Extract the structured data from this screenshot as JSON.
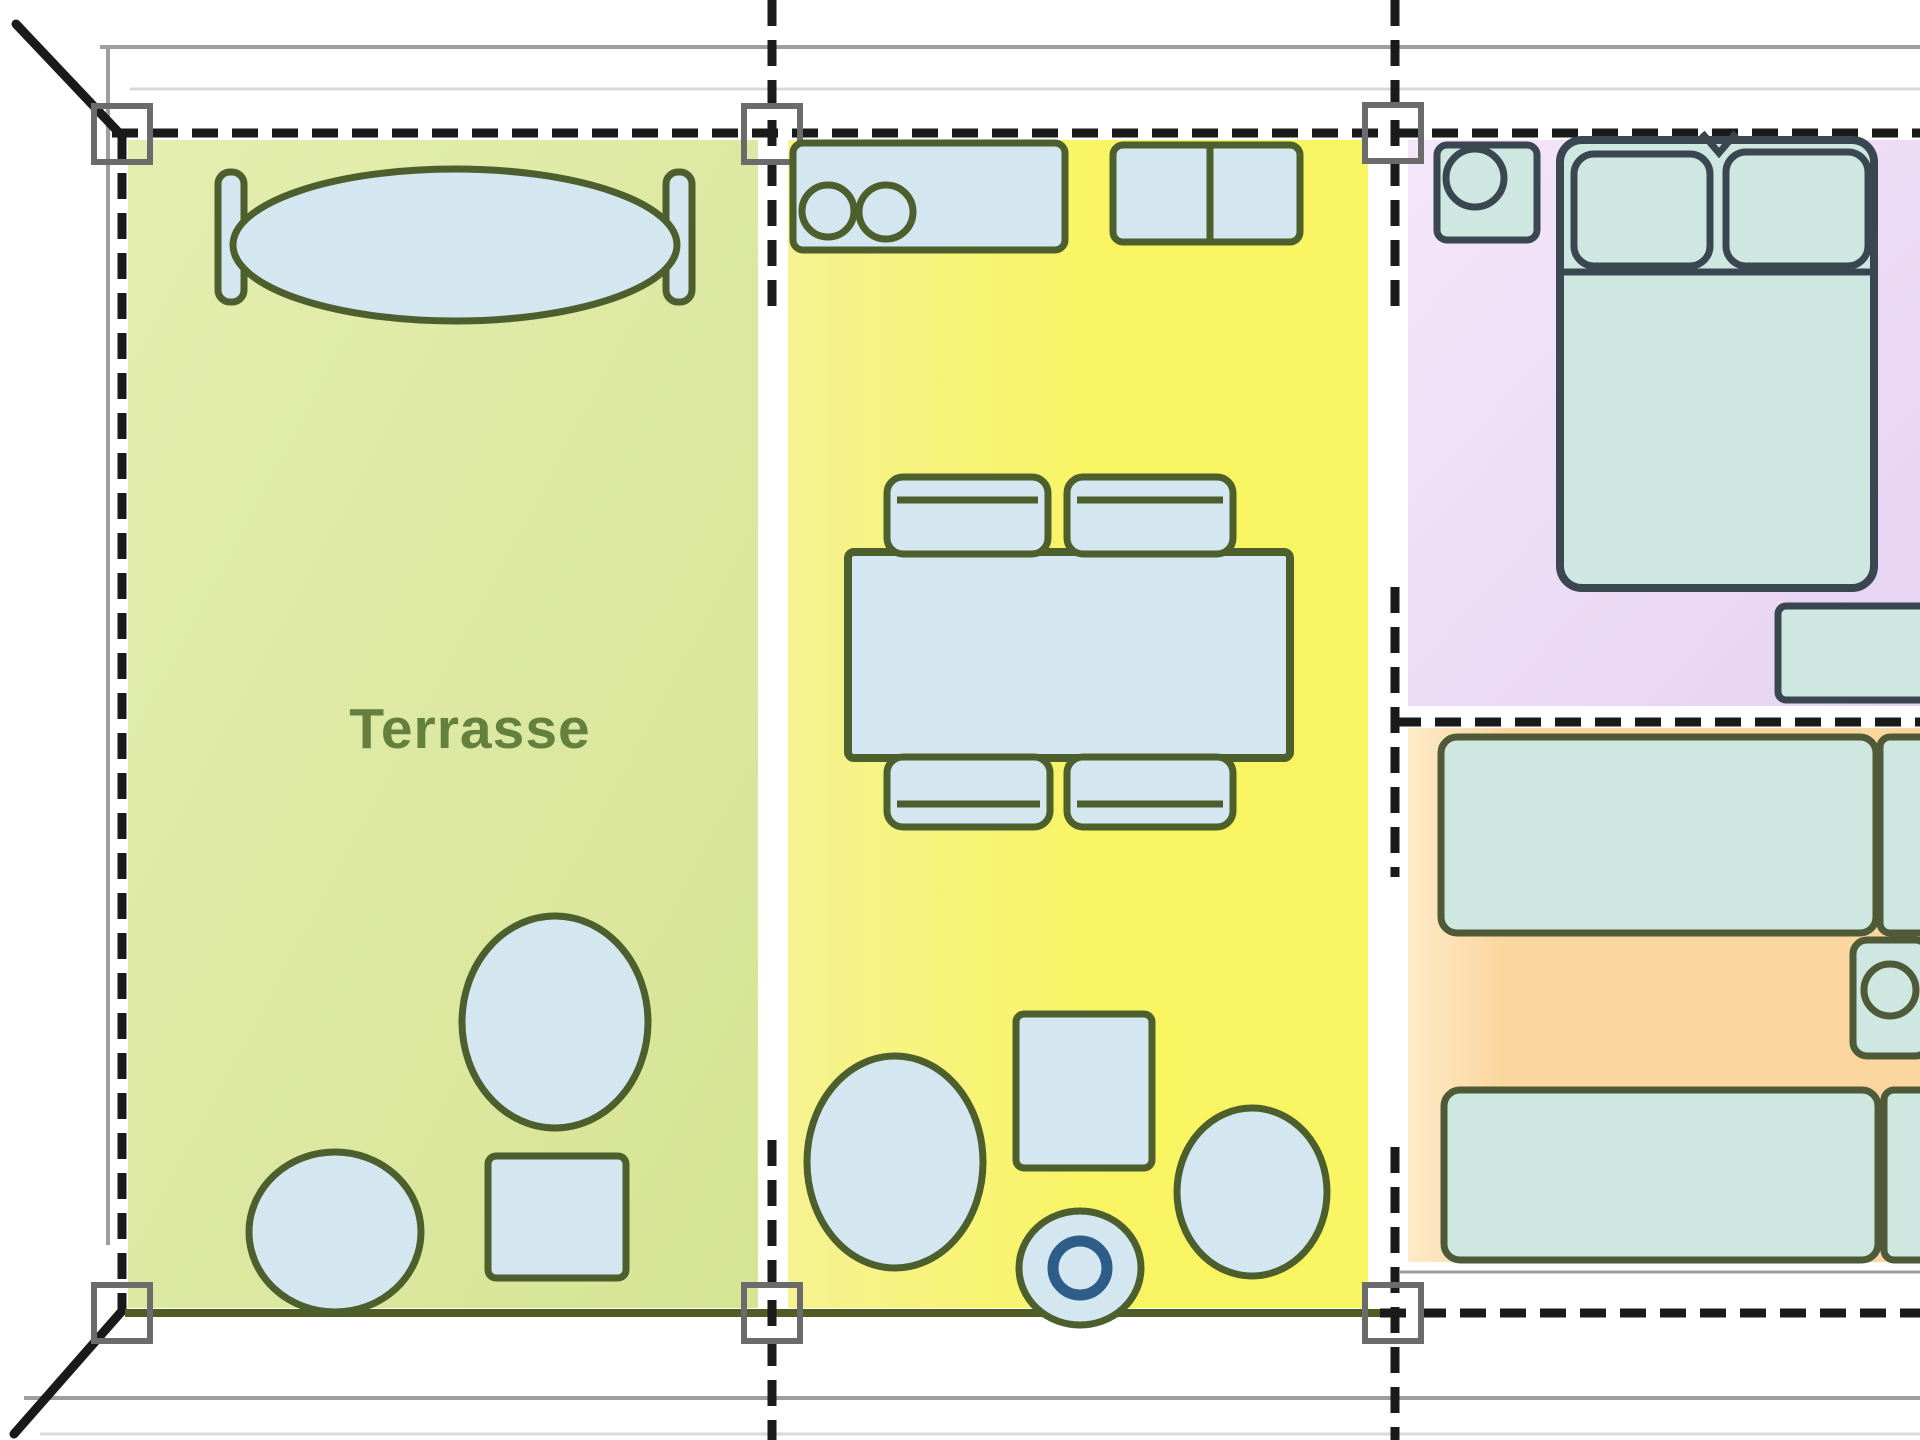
{
  "figure": {
    "type": "floor-plan",
    "terrace_label": "Terrasse"
  },
  "palette": {
    "guide_gray": "#9e9e9e",
    "guide_faint": "#d9d9d9",
    "wall_black": "#1a1a1a",
    "post_gray": "#6b6b6b",
    "olive_edge": "#4f5c23",
    "olive_stroke": "#4c5f2c",
    "olive2_stroke": "#4e5a38",
    "slate_stroke": "#3a4751",
    "blue_fill": "#d4e6f0",
    "teal_fill": "#cfe7e1",
    "ring_blue": "#2e5d8a",
    "label_green": "#64803f",
    "terrace_fill_a": "#e4eeb0",
    "terrace_fill_b": "#d6e494",
    "yellow_fill_a": "#f6f291",
    "yellow_fill_b": "#f9f562",
    "purple_fill_a": "#f4e6fa",
    "purple_fill_b": "#e6d2f2",
    "orange_fill_a": "#fdeac8",
    "orange_fill_b": "#fbd7a0"
  }
}
